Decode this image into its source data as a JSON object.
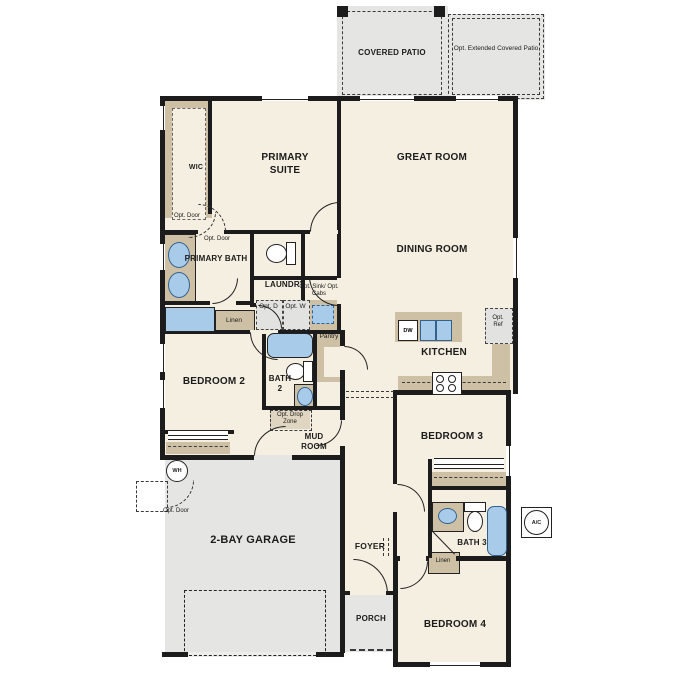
{
  "colors": {
    "floor": "#f5efe1",
    "exterior_concrete": "#e5e5e3",
    "counter_tan": "#cdc0a5",
    "fixture_blue": "#a9cbea",
    "wall_black": "#1c1c1c"
  },
  "rooms": {
    "covered_patio": "COVERED PATIO",
    "opt_extended_patio": "Opt. Extended Covered Patio",
    "wic": "WIC",
    "primary_suite": "PRIMARY SUITE",
    "great_room": "GREAT ROOM",
    "dining_room": "DINING ROOM",
    "primary_bath": "PRIMARY BATH",
    "laundry": "LAUNDRY",
    "kitchen": "KITCHEN",
    "bedroom_2": "BEDROOM 2",
    "bath_2": "BATH 2",
    "pantry": "Pantry",
    "mud_room": "MUD ROOM",
    "bedroom_3": "BEDROOM 3",
    "garage": "2-BAY GARAGE",
    "foyer": "FOYER",
    "bath_3": "BATH 3",
    "porch": "PORCH",
    "bedroom_4": "BEDROOM 4"
  },
  "annotations": {
    "opt_door_wic": "Opt. Door",
    "opt_door_suite": "Opt. Door",
    "opt_door_garage": "Opt. Door",
    "linen_hall": "Linen",
    "linen_bath3": "Linen",
    "opt_dryer": "Opt. D",
    "opt_washer": "Opt. W",
    "opt_sink_cabs": "Opt. Sink/ Opt. Cabs",
    "opt_ref": "Opt. Ref",
    "opt_drop_zone": "Opt. Drop Zone",
    "dishwasher": "DW",
    "water_heater": "WH",
    "ac_unit": "A/C"
  }
}
